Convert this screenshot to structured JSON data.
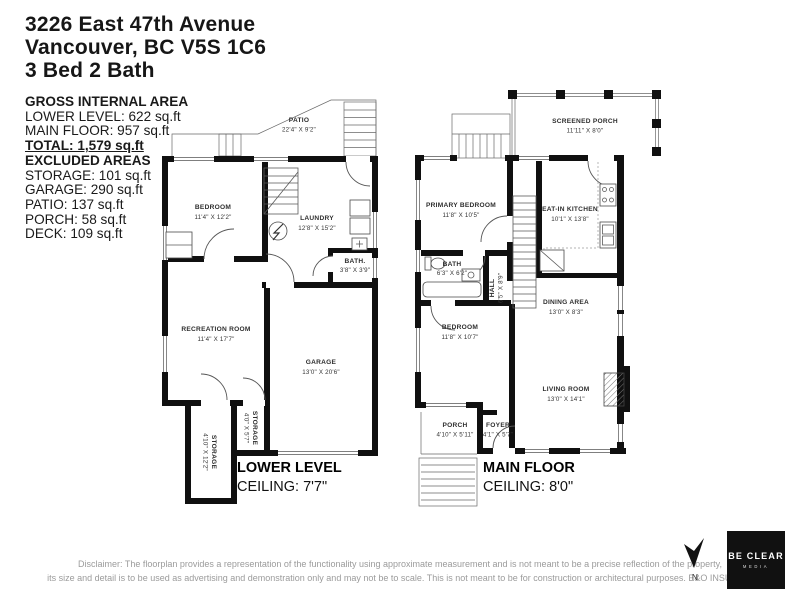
{
  "header": {
    "address_line1": "3226 East 47th Avenue",
    "address_line2": "Vancouver, BC V5S 1C6",
    "beds_baths": "3 Bed 2 Bath"
  },
  "area_summary": {
    "title": "GROSS INTERNAL AREA",
    "summary_lines": [
      "LOWER LEVEL: 622 sq.ft",
      "MAIN FLOOR: 957 sq.ft"
    ],
    "total": "TOTAL: 1,579 sq.ft",
    "excluded_title": "EXCLUDED AREAS",
    "excluded_lines": [
      "STORAGE: 101 sq.ft",
      "GARAGE: 290 sq.ft",
      "PATIO: 137 sq.ft",
      "PORCH: 58 sq.ft",
      "DECK: 109 sq.ft"
    ]
  },
  "lower_level": {
    "title": "LOWER LEVEL",
    "ceiling": "CEILING: 7'7\"",
    "rooms": {
      "patio": {
        "name": "PATIO",
        "dims": "22'4\" X 9'2\""
      },
      "bedroom": {
        "name": "BEDROOM",
        "dims": "11'4\" X 12'2\""
      },
      "laundry": {
        "name": "LAUNDRY",
        "dims": "12'8\" X 15'2\""
      },
      "bath": {
        "name": "BATH.",
        "dims": "3'8\" X 3'9\""
      },
      "recreation": {
        "name": "RECREATION ROOM",
        "dims": "11'4\" X 17'7\""
      },
      "garage": {
        "name": "GARAGE",
        "dims": "13'0\" X 20'6\""
      },
      "storage_small": {
        "name": "STORAGE",
        "dims": "4'0\" X 5'7\""
      },
      "storage_large": {
        "name": "STORAGE",
        "dims": "4'10\" X 12'2\""
      }
    }
  },
  "main_floor": {
    "title": "MAIN FLOOR",
    "ceiling": "CEILING: 8'0\"",
    "rooms": {
      "screened_porch": {
        "name": "SCREENED PORCH",
        "dims": "11'11\" X 8'0\""
      },
      "primary_bedroom": {
        "name": "PRIMARY BEDROOM",
        "dims": "11'8\" X 10'5\""
      },
      "eat_in_kitchen": {
        "name": "EAT-IN KITCHEN",
        "dims": "10'1\" X 13'8\""
      },
      "bath": {
        "name": "BATH",
        "dims": "6'3\" X 6'2\""
      },
      "hall": {
        "name": "HALL",
        "dims": "6'5\" X 8'9\""
      },
      "dining": {
        "name": "DINING AREA",
        "dims": "13'0\" X 8'3\""
      },
      "bedroom": {
        "name": "BEDROOM",
        "dims": "11'8\" X 10'7\""
      },
      "living": {
        "name": "LIVING ROOM",
        "dims": "13'0\" X 14'1\""
      },
      "porch": {
        "name": "PORCH",
        "dims": "4'10\" X 5'11\""
      },
      "foyer": {
        "name": "FOYER",
        "dims": "4'1\" X 5'7\""
      }
    }
  },
  "footer": {
    "disclaimer_line1": "Disclaimer: The floorplan provides a representation of the functionality using approximate measurement and is not meant to be a precise reflection of the property,",
    "disclaimer_line2": "its size and detail is to be used as advertising and demonstration only and may not be to scale. This is not meant to be for construction or architectural purposes. E&O INSURED.",
    "compass_label": "N",
    "logo_line1": "BE CLEAR",
    "logo_line2": "MEDIA"
  },
  "colors": {
    "wall": "#101010",
    "ink": "#1a1a1a",
    "muted_text": "#9b9b9b",
    "logo_bg": "#111111"
  }
}
